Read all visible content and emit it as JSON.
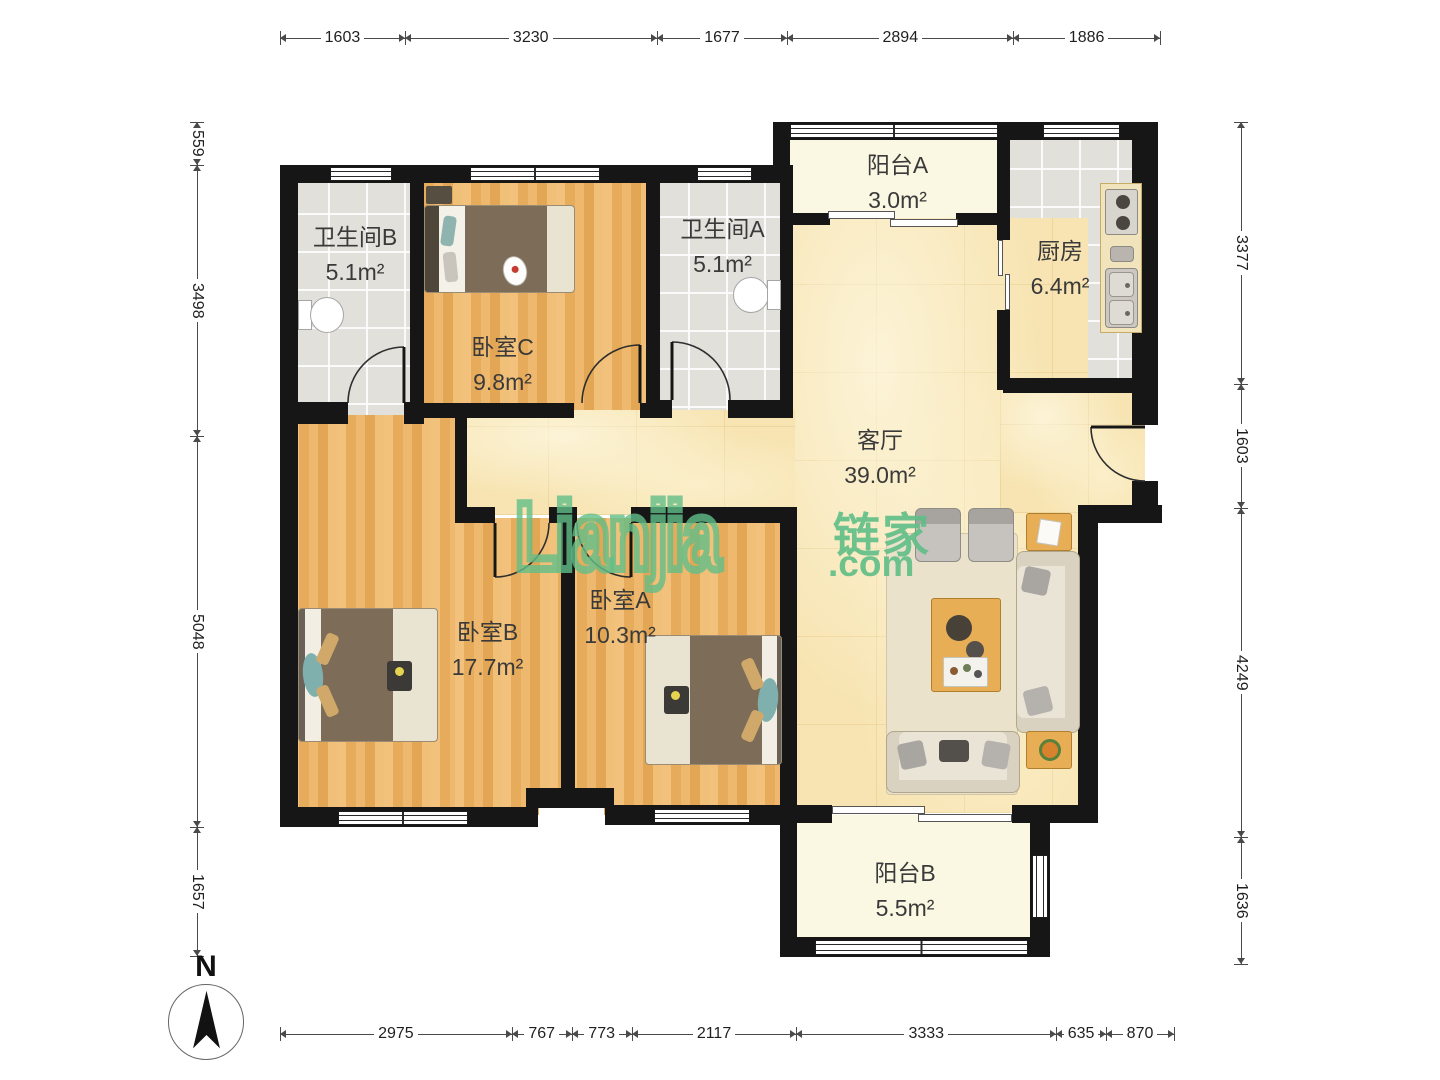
{
  "watermark": {
    "logo": "Lianjia",
    "brand_cjk": "链家",
    "domain": ".com"
  },
  "compass": {
    "north_label": "N"
  },
  "rooms": {
    "bathroom_b": {
      "name": "卫生间B",
      "area": "5.1m²"
    },
    "bedroom_c": {
      "name": "卧室C",
      "area": "9.8m²"
    },
    "bathroom_a": {
      "name": "卫生间A",
      "area": "5.1m²"
    },
    "balcony_a": {
      "name": "阳台A",
      "area": "3.0m²"
    },
    "kitchen": {
      "name": "厨房",
      "area": "6.4m²"
    },
    "living_room": {
      "name": "客厅",
      "area": "39.0m²"
    },
    "bedroom_b": {
      "name": "卧室B",
      "area": "17.7m²"
    },
    "bedroom_a": {
      "name": "卧室A",
      "area": "10.3m²"
    },
    "balcony_b": {
      "name": "阳台B",
      "area": "5.5m²"
    }
  },
  "dimensions": {
    "top": [
      "1603",
      "3230",
      "1677",
      "2894",
      "1886"
    ],
    "bottom": [
      "2975",
      "767",
      "773",
      "2117",
      "3333",
      "635",
      "870"
    ],
    "left": [
      "559",
      "3498",
      "5048",
      "1657"
    ],
    "right": [
      "3377",
      "1603",
      "4249",
      "1636"
    ]
  },
  "colors": {
    "brand_green": "#61be88",
    "wall": "#161616",
    "wood_floor": "#eab466",
    "marble_floor": "#f7e4b2",
    "tile_floor": "#e9e7e2",
    "balcony_floor": "#faf7e2"
  }
}
